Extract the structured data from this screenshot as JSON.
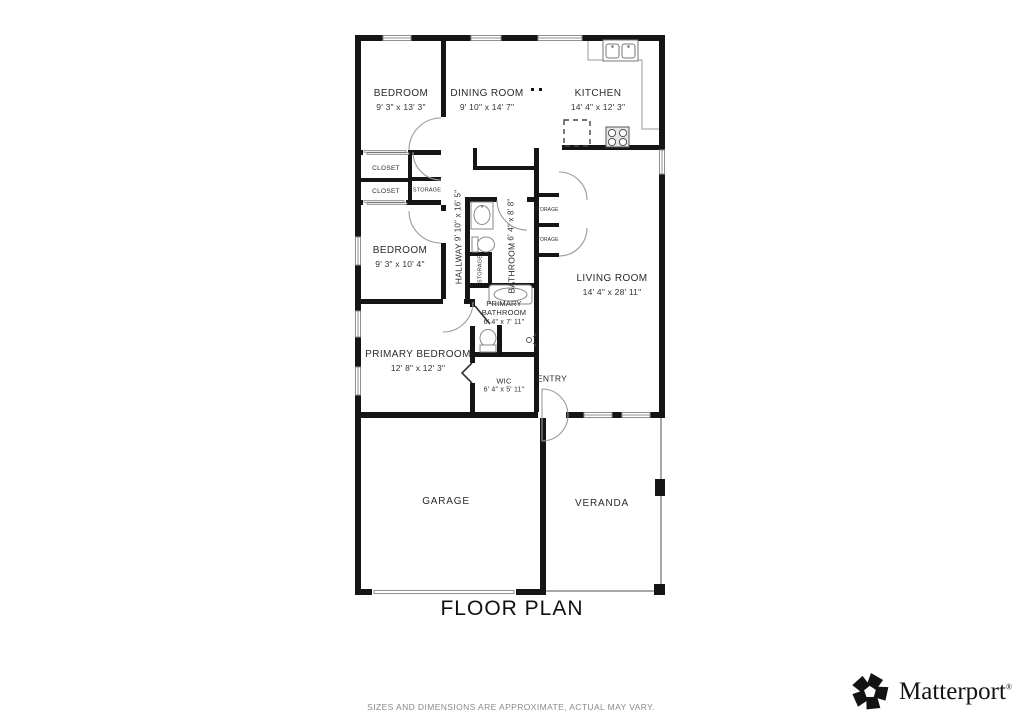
{
  "title": "FLOOR PLAN",
  "disclaimer": "SIZES AND DIMENSIONS ARE APPROXIMATE, ACTUAL MAY VARY.",
  "brand": {
    "wordmark": "Matterport",
    "registered": "®",
    "icon": "matterport-pinwheel-icon"
  },
  "colors": {
    "walls": "#151515",
    "thin_lines": "#9a9a9a",
    "labels": "#2b2b2b",
    "disclaimer_text": "#8a8a8a"
  },
  "rooms": {
    "bedroom1": {
      "name": "BEDROOM",
      "dims": "9' 3\" x 13' 3\""
    },
    "dining": {
      "name": "DINING ROOM",
      "dims": "9' 10\" x 14' 7\""
    },
    "kitchen": {
      "name": "KITCHEN",
      "dims": "14' 4\" x 12' 3\""
    },
    "closet1": {
      "name": "CLOSET"
    },
    "closet2": {
      "name": "CLOSET"
    },
    "storage_hall": {
      "name": "STORAGE"
    },
    "bedroom2": {
      "name": "BEDROOM",
      "dims": "9' 3\" x 10' 4\""
    },
    "hallway": {
      "name": "HALLWAY",
      "dims": "9' 10\" x 16' 5\""
    },
    "bathroom": {
      "name": "BATHROOM",
      "dims": "6' 4\" x 8' 8\""
    },
    "storage_bath": {
      "name": "STORAGE"
    },
    "storage_living1": {
      "name": "STORAGE"
    },
    "storage_living2": {
      "name": "STORAGE"
    },
    "living": {
      "name": "LIVING ROOM",
      "dims": "14' 4\" x 28' 11\""
    },
    "primary_bathroom": {
      "name": "PRIMARY BATHROOM",
      "dims": "6' 4\" x 7' 11\""
    },
    "primary_bedroom": {
      "name": "PRIMARY BEDROOM",
      "dims": "12' 8\" x 12' 3\""
    },
    "wic": {
      "name": "WIC",
      "dims": "6' 4\" x 5' 11\""
    },
    "entry": {
      "name": "ENTRY"
    },
    "garage": {
      "name": "GARAGE"
    },
    "veranda": {
      "name": "VERANDA"
    }
  }
}
